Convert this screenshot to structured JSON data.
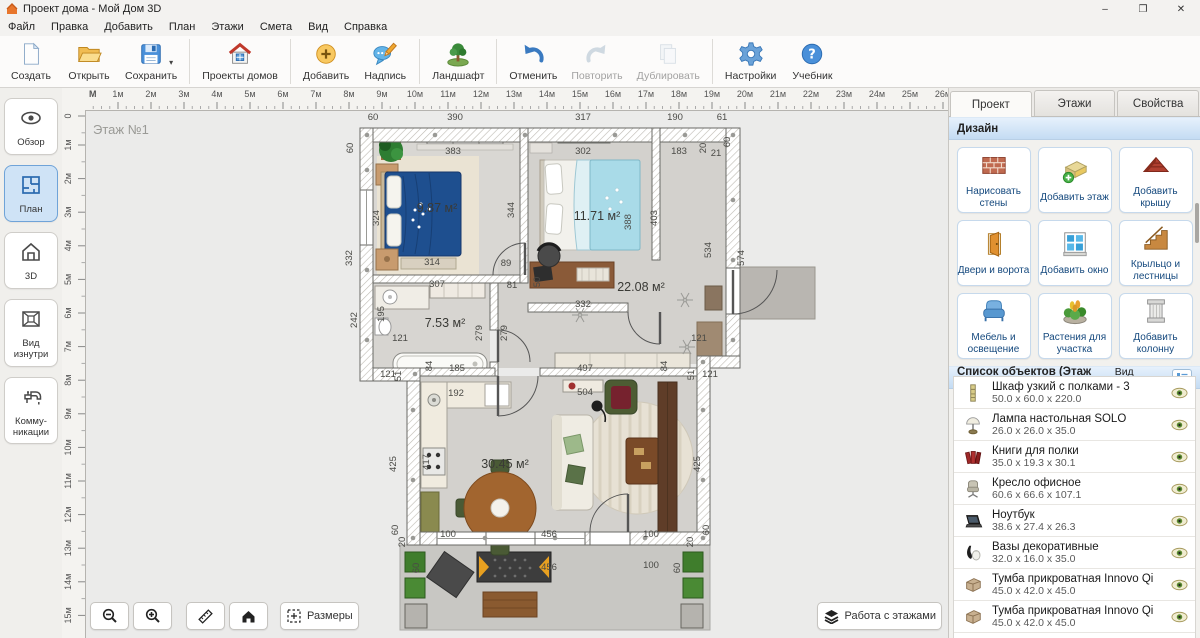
{
  "window": {
    "title": "Проект дома - Мой Дом 3D",
    "minimize": "–",
    "maximize": "❐",
    "close": "✕"
  },
  "menu": {
    "items": [
      "Файл",
      "Правка",
      "Добавить",
      "План",
      "Этажи",
      "Смета",
      "Вид",
      "Справка"
    ]
  },
  "toolbar": {
    "buttons": [
      {
        "name": "new",
        "label": "Создать",
        "icon": "new-document"
      },
      {
        "name": "open",
        "label": "Открыть",
        "icon": "open-folder"
      },
      {
        "name": "save",
        "label": "Сохранить",
        "icon": "save-floppy",
        "dropdown": "▾"
      },
      {
        "sep": true
      },
      {
        "name": "house-projects",
        "label": "Проекты домов",
        "icon": "house-projects"
      },
      {
        "sep": true
      },
      {
        "name": "add",
        "label": "Добавить",
        "icon": "add-plus"
      },
      {
        "name": "label",
        "label": "Надпись",
        "icon": "label-bubble"
      },
      {
        "sep": true
      },
      {
        "name": "landscape",
        "label": "Ландшафт",
        "icon": "landscape-tree"
      },
      {
        "sep": true
      },
      {
        "name": "undo",
        "label": "Отменить",
        "icon": "undo-arrow"
      },
      {
        "name": "redo",
        "label": "Повторить",
        "icon": "redo-arrow",
        "disabled": true
      },
      {
        "name": "duplicate",
        "label": "Дублировать",
        "icon": "duplicate-pages",
        "disabled": true
      },
      {
        "sep": true
      },
      {
        "name": "settings",
        "label": "Настройки",
        "icon": "settings-gear"
      },
      {
        "name": "tutorial",
        "label": "Учебник",
        "icon": "help-circle"
      }
    ]
  },
  "sidebar": {
    "items": [
      {
        "name": "overview",
        "label": "Обзор",
        "icon": "eye"
      },
      {
        "name": "plan",
        "label": "План",
        "icon": "floor-plan",
        "active": true
      },
      {
        "name": "3d",
        "label": "3D",
        "icon": "house-3d"
      },
      {
        "name": "interior",
        "label": "Вид изнутри",
        "icon": "interior-view"
      },
      {
        "name": "communications",
        "label": "Комму-никации",
        "icon": "faucet"
      }
    ]
  },
  "rulers": {
    "unit": "М",
    "h_ticks": [
      "1м",
      "2м",
      "3м",
      "4м",
      "5м",
      "6м",
      "7м",
      "8м",
      "9м",
      "10м",
      "11м",
      "12м",
      "13м",
      "14м",
      "15м",
      "16м",
      "17м",
      "18м",
      "19м",
      "20м",
      "21м",
      "22м",
      "23м",
      "24м",
      "25м",
      "26м"
    ],
    "v_ticks": [
      "0",
      "1м",
      "2м",
      "3м",
      "4м",
      "5м",
      "6м",
      "7м",
      "8м",
      "9м",
      "10м",
      "11м",
      "12м",
      "13м",
      "14м",
      "15м"
    ]
  },
  "canvas": {
    "floor_label": "Этаж №1",
    "area_labels": [
      {
        "text": "9.87 м²",
        "x": 352,
        "y": 102
      },
      {
        "text": "11.71 м²",
        "x": 512,
        "y": 110
      },
      {
        "text": "7.53 м²",
        "x": 360,
        "y": 217
      },
      {
        "text": "22.08 м²",
        "x": 556,
        "y": 181
      },
      {
        "text": "30.45 м²",
        "x": 420,
        "y": 358
      }
    ],
    "dim_labels": [
      {
        "t": "60",
        "x": 288,
        "y": 10
      },
      {
        "t": "390",
        "x": 370,
        "y": 10
      },
      {
        "t": "317",
        "x": 498,
        "y": 10
      },
      {
        "t": "190",
        "x": 590,
        "y": 10
      },
      {
        "t": "61",
        "x": 637,
        "y": 10
      },
      {
        "t": "383",
        "x": 368,
        "y": 44
      },
      {
        "t": "302",
        "x": 498,
        "y": 44
      },
      {
        "t": "183",
        "x": 594,
        "y": 44
      },
      {
        "t": "20",
        "x": 621,
        "y": 38,
        "r": -90
      },
      {
        "t": "21",
        "x": 631,
        "y": 46
      },
      {
        "t": "60",
        "x": 645,
        "y": 32,
        "r": -90
      },
      {
        "t": "60",
        "x": 268,
        "y": 38,
        "r": -90
      },
      {
        "t": "332",
        "x": 267,
        "y": 148,
        "r": -90
      },
      {
        "t": "324",
        "x": 294,
        "y": 108,
        "r": -90
      },
      {
        "t": "314",
        "x": 347,
        "y": 155
      },
      {
        "t": "344",
        "x": 429,
        "y": 100,
        "r": -90
      },
      {
        "t": "388",
        "x": 546,
        "y": 112,
        "r": -90
      },
      {
        "t": "403",
        "x": 572,
        "y": 108,
        "r": -90
      },
      {
        "t": "534",
        "x": 626,
        "y": 140,
        "r": -90
      },
      {
        "t": "574",
        "x": 659,
        "y": 148,
        "r": -90
      },
      {
        "t": "89",
        "x": 421,
        "y": 156
      },
      {
        "t": "81",
        "x": 427,
        "y": 178
      },
      {
        "t": "307",
        "x": 352,
        "y": 177
      },
      {
        "t": "332",
        "x": 498,
        "y": 197
      },
      {
        "t": "50",
        "x": 455,
        "y": 172,
        "r": -90
      },
      {
        "t": "242",
        "x": 272,
        "y": 210,
        "r": -90
      },
      {
        "t": "195",
        "x": 299,
        "y": 204,
        "r": -90
      },
      {
        "t": "121",
        "x": 315,
        "y": 231
      },
      {
        "t": "279",
        "x": 397,
        "y": 223,
        "r": -90
      },
      {
        "t": "279",
        "x": 422,
        "y": 223,
        "r": -90
      },
      {
        "t": "185",
        "x": 372,
        "y": 261
      },
      {
        "t": "84",
        "x": 347,
        "y": 256,
        "r": -90
      },
      {
        "t": "497",
        "x": 500,
        "y": 261
      },
      {
        "t": "84",
        "x": 582,
        "y": 256,
        "r": -90
      },
      {
        "t": "121",
        "x": 614,
        "y": 231
      },
      {
        "t": "121",
        "x": 303,
        "y": 267
      },
      {
        "t": "51",
        "x": 316,
        "y": 266,
        "r": -90
      },
      {
        "t": "51",
        "x": 609,
        "y": 265,
        "r": -90
      },
      {
        "t": "121",
        "x": 625,
        "y": 267
      },
      {
        "t": "192",
        "x": 371,
        "y": 286
      },
      {
        "t": "504",
        "x": 500,
        "y": 285
      },
      {
        "t": "417",
        "x": 344,
        "y": 352,
        "r": -90
      },
      {
        "t": "425",
        "x": 311,
        "y": 354,
        "r": -90
      },
      {
        "t": "425",
        "x": 615,
        "y": 354,
        "r": -90
      },
      {
        "t": "100",
        "x": 363,
        "y": 427
      },
      {
        "t": "456",
        "x": 464,
        "y": 427
      },
      {
        "t": "100",
        "x": 566,
        "y": 427
      },
      {
        "t": "60",
        "x": 313,
        "y": 420,
        "r": -90
      },
      {
        "t": "60",
        "x": 624,
        "y": 420,
        "r": -90
      },
      {
        "t": "20",
        "x": 320,
        "y": 432,
        "r": -90
      },
      {
        "t": "20",
        "x": 608,
        "y": 432,
        "r": -90
      },
      {
        "t": "456",
        "x": 464,
        "y": 460
      },
      {
        "t": "100",
        "x": 566,
        "y": 458
      },
      {
        "t": "60",
        "x": 334,
        "y": 458,
        "r": -90
      },
      {
        "t": "60",
        "x": 595,
        "y": 458,
        "r": -90
      }
    ]
  },
  "bottom_bar": {
    "dimensions_label": "Размеры",
    "floors_label": "Работа с этажами"
  },
  "right_panel": {
    "tabs": [
      {
        "name": "project",
        "label": "Проект",
        "active": true
      },
      {
        "name": "floors",
        "label": "Этажи"
      },
      {
        "name": "properties",
        "label": "Свойства"
      }
    ],
    "design": {
      "header": "Дизайн",
      "buttons": [
        {
          "name": "draw-walls",
          "label": "Нарисовать стены",
          "icon": "brick-wall"
        },
        {
          "name": "add-floor",
          "label": "Добавить этаж",
          "icon": "add-floor"
        },
        {
          "name": "add-roof",
          "label": "Добавить крышу",
          "icon": "roof"
        },
        {
          "name": "doors-gates",
          "label": "Двери и ворота",
          "icon": "door"
        },
        {
          "name": "add-window",
          "label": "Добавить окно",
          "icon": "window"
        },
        {
          "name": "porch-stairs",
          "label": "Крыльцо и лестницы",
          "icon": "stairs"
        },
        {
          "name": "furniture-light",
          "label": "Мебель и освещение",
          "icon": "armchair"
        },
        {
          "name": "plants",
          "label": "Растения для участка",
          "icon": "plants"
        },
        {
          "name": "add-column",
          "label": "Добавить колонну",
          "icon": "column"
        }
      ]
    },
    "object_list": {
      "header": "Список объектов (Этаж №1)",
      "view_label": "Вид списка",
      "items": [
        {
          "name": "Шкаф узкий с полками - 3",
          "dims": "50.0 x 60.0 x 220.0",
          "icon": "shelf"
        },
        {
          "name": "Лампа настольная SOLO",
          "dims": "26.0 x 26.0 x 35.0",
          "icon": "lamp"
        },
        {
          "name": "Книги для полки",
          "dims": "35.0 x 19.3 x 30.1",
          "icon": "books"
        },
        {
          "name": "Кресло офисное",
          "dims": "60.6 x 66.6 x 107.1",
          "icon": "office-chair"
        },
        {
          "name": "Ноутбук",
          "dims": "38.6 x 27.4 x 26.3",
          "icon": "laptop"
        },
        {
          "name": "Вазы декоративные",
          "dims": "32.0 x 16.0 x 35.0",
          "icon": "vases"
        },
        {
          "name": "Тумба прикроватная Innovo Qi",
          "dims": "45.0 x 42.0 x 45.0",
          "icon": "nightstand"
        },
        {
          "name": "Тумба прикроватная Innovo Qi",
          "dims": "45.0 x 42.0 x 45.0",
          "icon": "nightstand"
        },
        {
          "name": "Картины на холсте",
          "dims": "",
          "icon": "pictures"
        }
      ]
    }
  }
}
